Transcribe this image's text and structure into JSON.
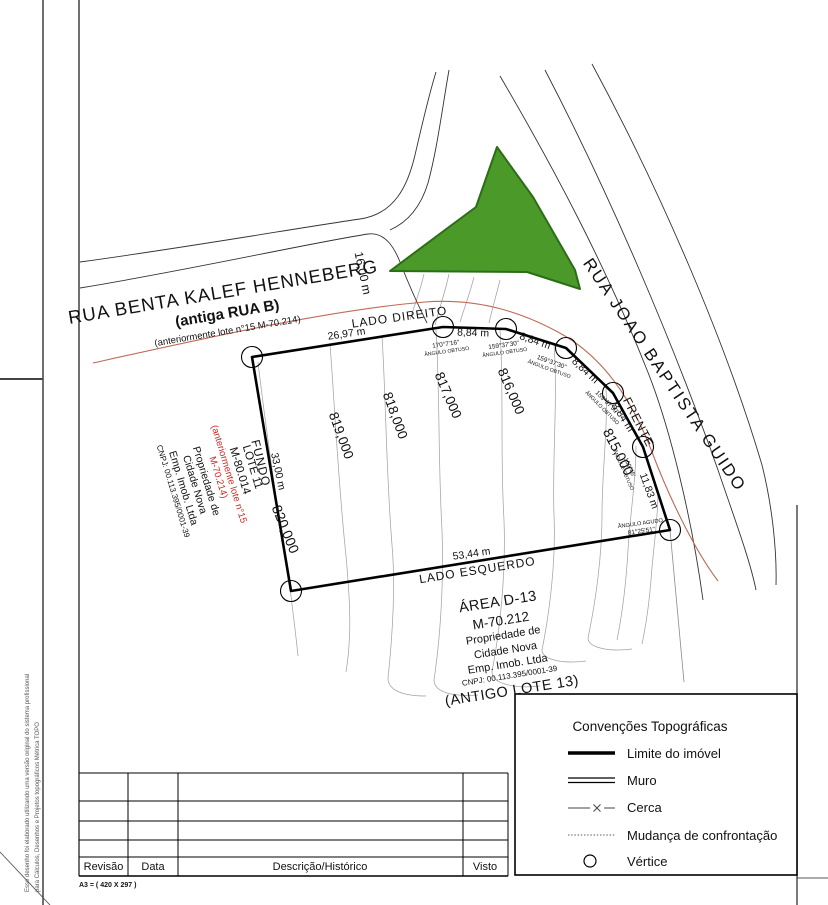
{
  "colors": {
    "green_fill": "#4a9929",
    "green_stroke": "#2c6d17",
    "side_label_orange": "#d89a33",
    "angle_blue": "#3b3bbd",
    "street_red": "#cc2822",
    "confrontation_red_line": "#bf6a55"
  },
  "frame": {
    "size_note": "A3 = ( 420 X 297 )",
    "disclaimer_line1": "Esse desenho foi elaborado utilizando uma versão original do sistema profissional",
    "disclaimer_line2": "para Cálculos, Desenhos e Projetos topográficos Métrica TOPO"
  },
  "streets": {
    "rua_benta": "RUA BENTA KALEF HENNEBERG",
    "rua_benta_old_name": "(antiga RUA B)",
    "rua_benta_prev_lot": "(anteriormente lote n°15 M-70.214)",
    "rua_joao": "RUA JOAO BAPTISTA GUIDO",
    "width_rua_joao": "16,00 m"
  },
  "lot": {
    "side_labels": {
      "right": "LADO DIREITO",
      "front": "FRENTE",
      "left": "LADO ESQUERDO",
      "back": "FUNDO"
    },
    "dimensions": {
      "top": "26,97 m",
      "seg": "8,84 m",
      "front_right": "11,83 m",
      "bottom": "53,44 m",
      "back": "33,00 m"
    },
    "angles": [
      {
        "value": "170°7'16\"",
        "type": "ÂNGULO OBTUSO"
      },
      {
        "value": "159°37'30\"",
        "type": "ÂNGULO OBTUSO"
      },
      {
        "value": "159°37'30\"",
        "type": "ÂNGULO OBTUSO"
      },
      {
        "value": "159°37'30\"",
        "type": "ÂNGULO OBTUSO"
      },
      {
        "value": "169°45'",
        "type": "ÂNGULO OBTUSO"
      },
      {
        "value": "81°25'51\"",
        "type": "ÂNGULO AGUDO"
      }
    ],
    "owner_block": {
      "line1": "LOTE 11",
      "line2": "M-80.014",
      "line3": "(anteriormente lote n°15",
      "line4": "M-70.214)",
      "line5": "Propriedade de",
      "line6": "Cidade Nova",
      "line7": "Emp. Imob. Ltda",
      "line8": "CNPJ: 00.113.395/0001-39"
    }
  },
  "adjacent_area": {
    "line1": "ÁREA D-13",
    "line2": "M-70.212",
    "line3": "Propriedade de",
    "line4": "Cidade Nova",
    "line5": "Emp. Imob. Ltda",
    "line6": "CNPJ: 00.113.395/0001-39",
    "line7": "(ANTIGO LOTE 13)"
  },
  "contours": {
    "labels": [
      "820,000",
      "819,000",
      "818,000",
      "817,000",
      "816,000",
      "815,000"
    ]
  },
  "legend": {
    "title": "Convenções Topográficas",
    "items": [
      {
        "label": "Limite do imóvel",
        "symbol": "thick-solid-line"
      },
      {
        "label": "Muro",
        "symbol": "double-line"
      },
      {
        "label": "Cerca",
        "symbol": "line-with-x"
      },
      {
        "label": "Mudança de confrontação",
        "symbol": "dotted-line"
      },
      {
        "label": "Vértice",
        "symbol": "circle"
      }
    ]
  },
  "revision_table": {
    "headers": [
      "Revisão",
      "Data",
      "Descrição/Histórico",
      "Visto"
    ],
    "empty_rows": 4
  }
}
